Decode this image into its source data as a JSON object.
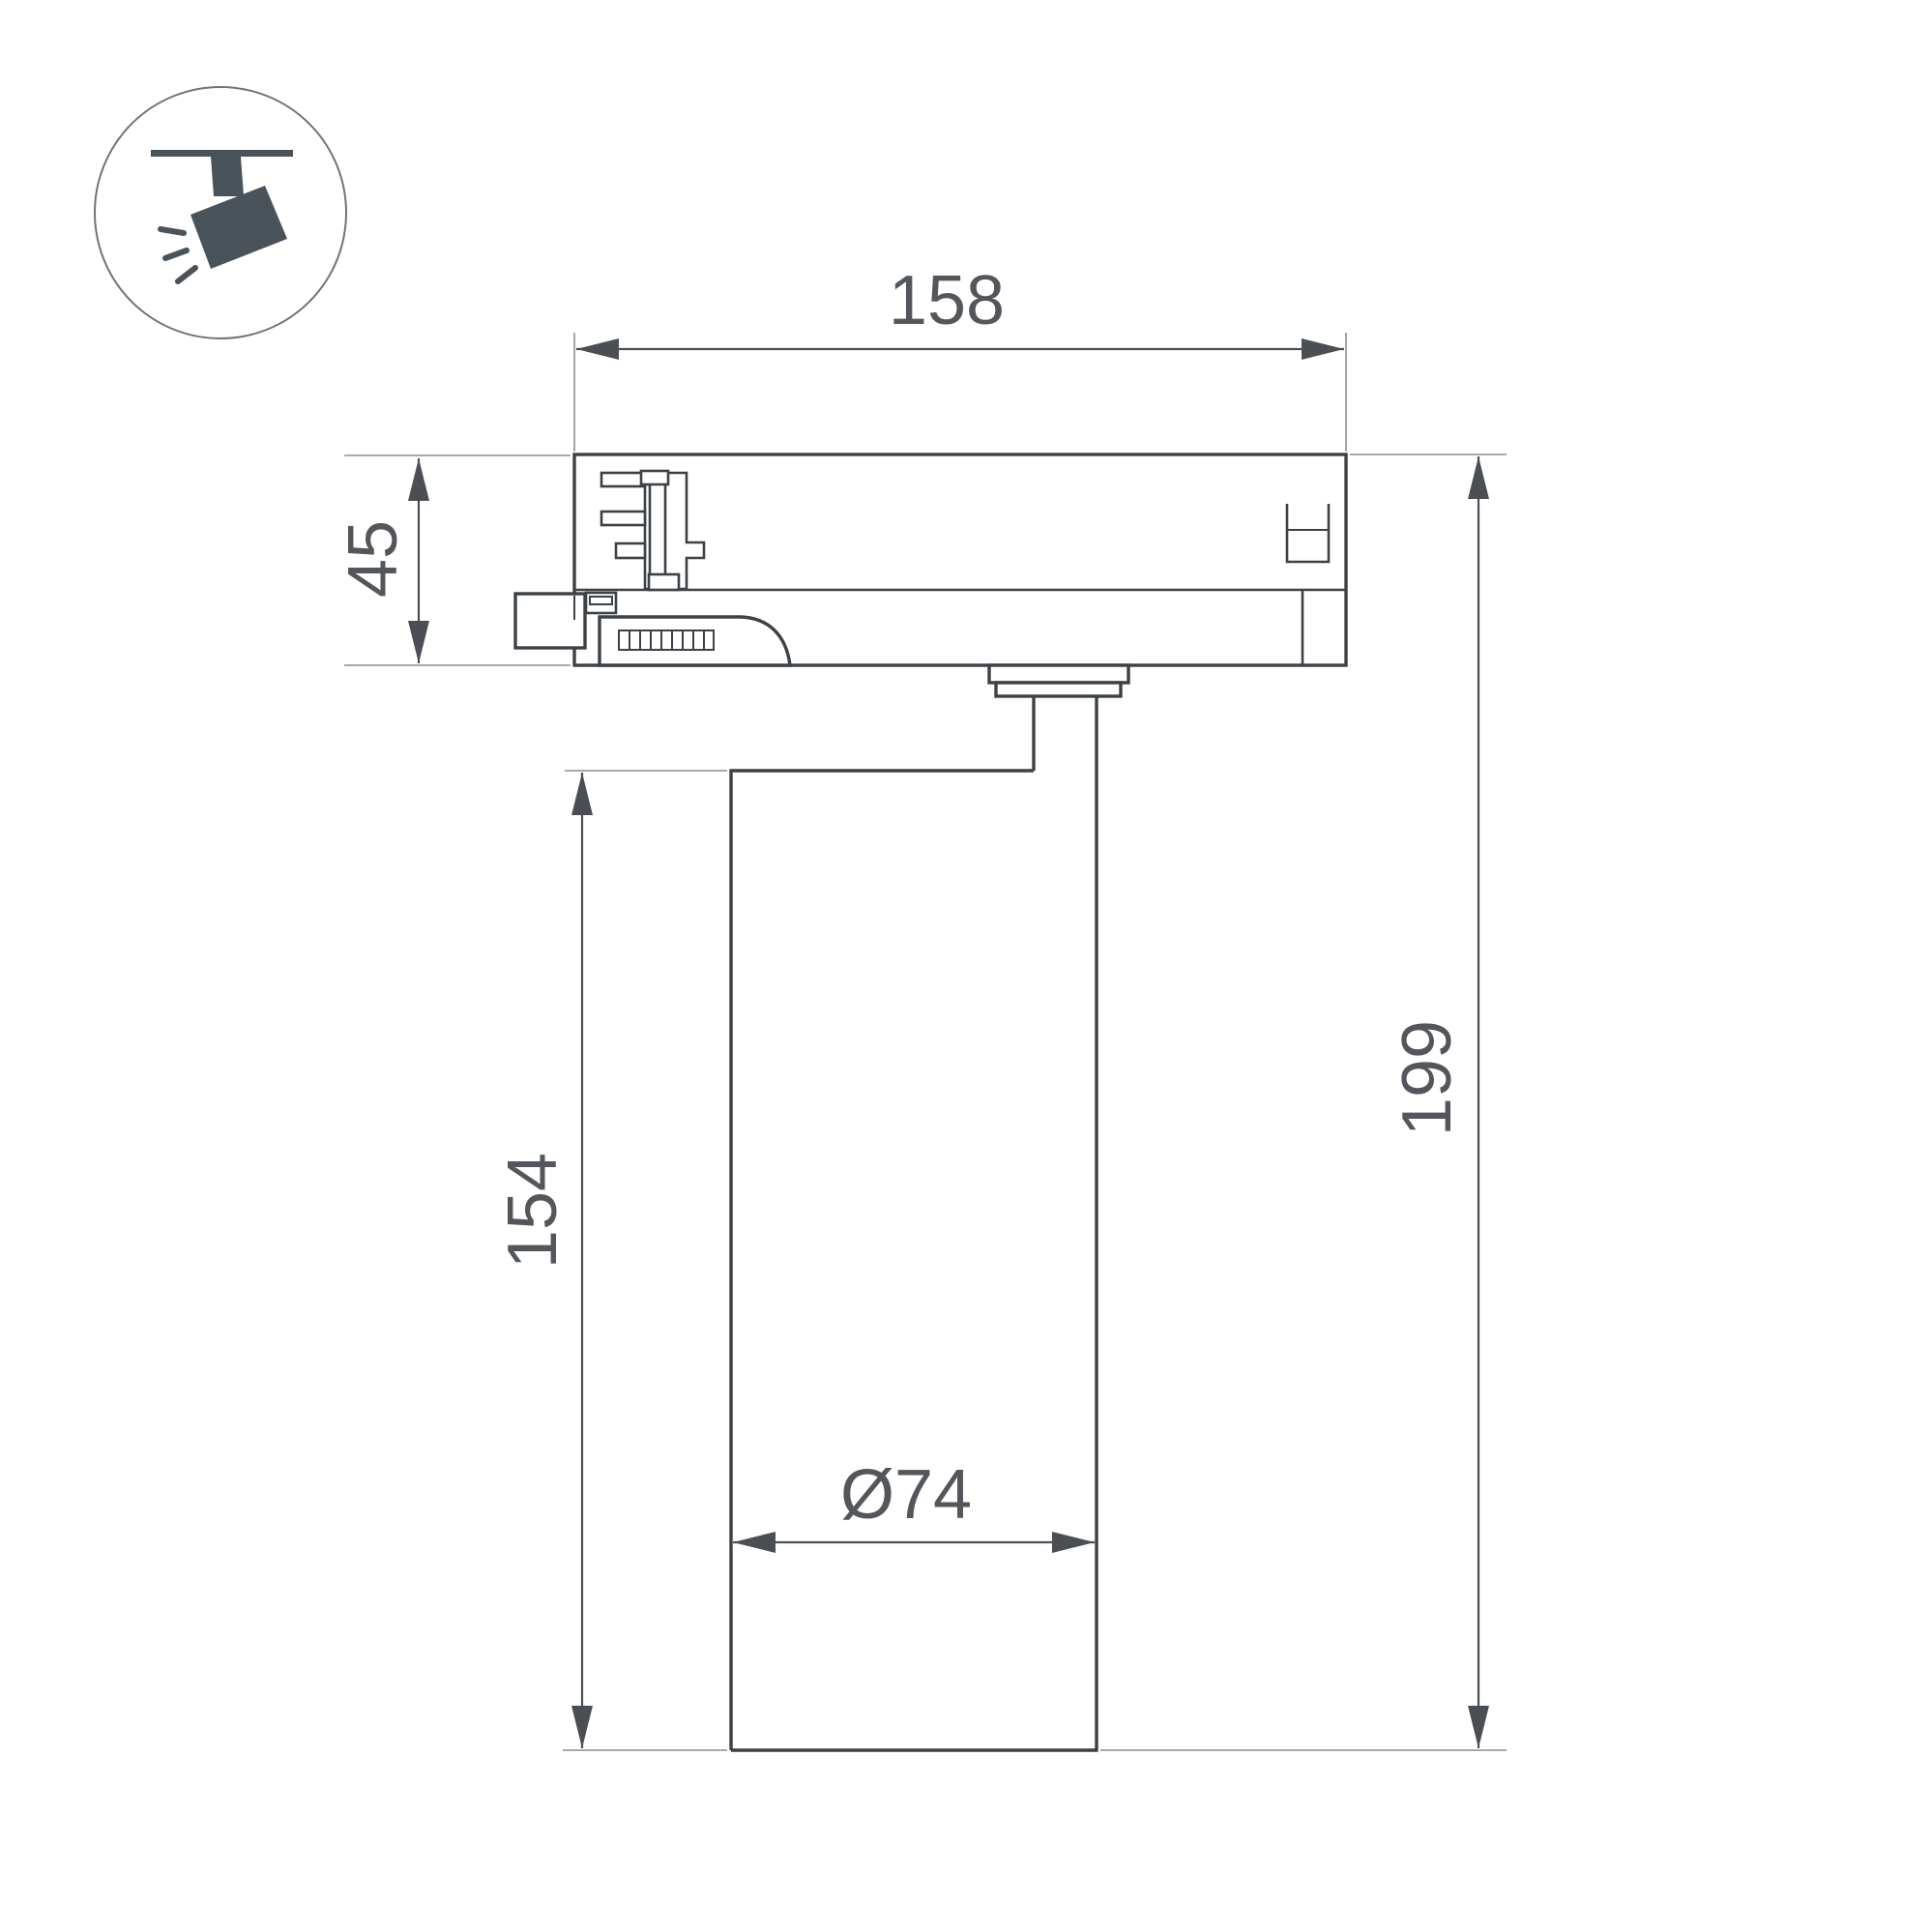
{
  "drawing": {
    "kind": "technical-dimension-drawing",
    "subject": "track-mounted spotlight, side view with mounting track adapter",
    "icon": {
      "name": "track-spotlight-icon"
    },
    "dimensions": {
      "adapter_width": "158",
      "adapter_height": "45",
      "body_height": "154",
      "total_height": "199",
      "body_diameter": "Ø74"
    },
    "colors": {
      "outline": "#3c4146",
      "dimension_line": "#4b4f54",
      "extension_line": "#9b9da0",
      "text": "#53565a",
      "icon_fill": "#4a525a",
      "icon_circle_stroke": "#6f7478",
      "background": "#ffffff"
    }
  }
}
